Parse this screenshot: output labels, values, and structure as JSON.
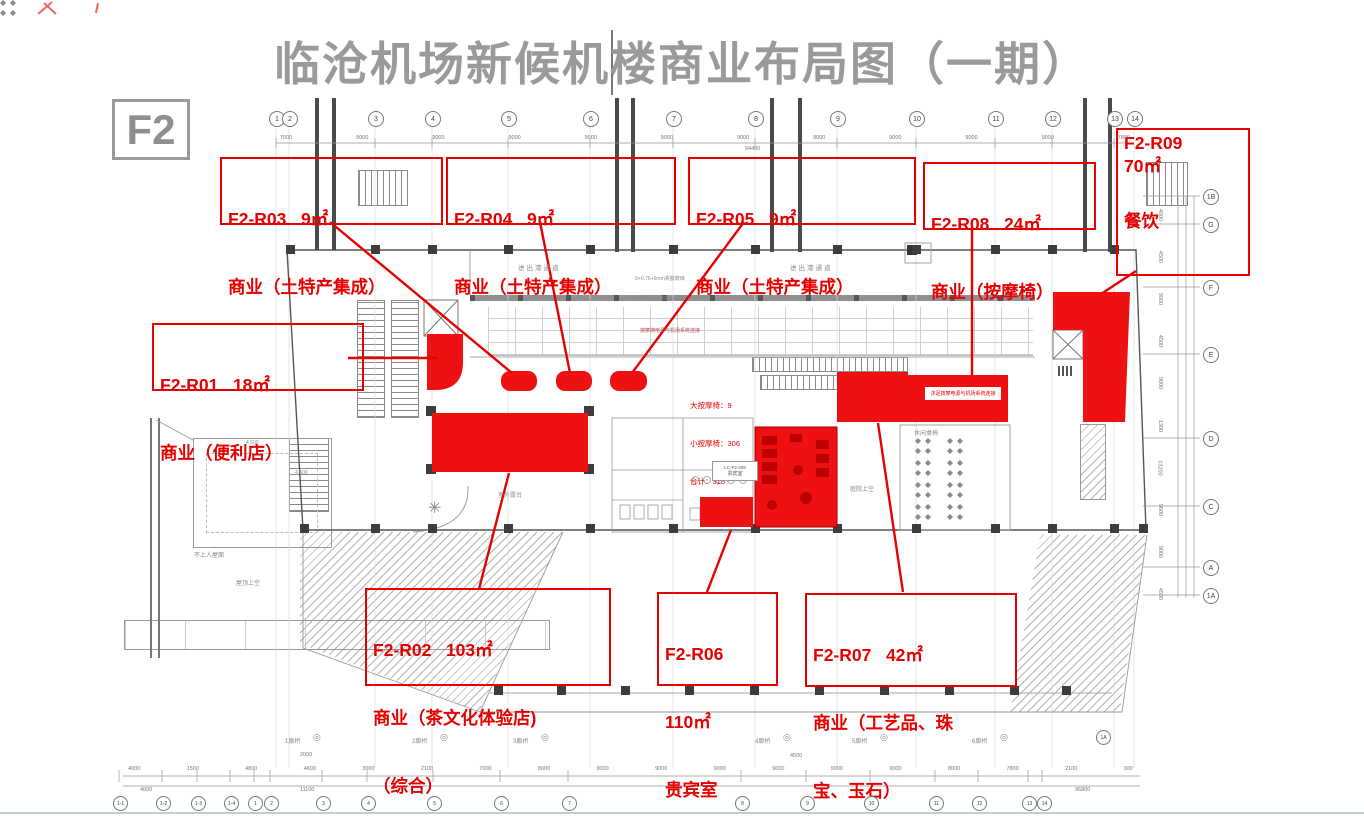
{
  "page": {
    "title": "临沧机场新候机楼商业布局图（一期）",
    "floor_label": "F2"
  },
  "colors": {
    "accent_red": "#e60000",
    "region_red": "#ee1111",
    "title_gray": "#9a9a9a",
    "line_gray": "#555555"
  },
  "labels": [
    {
      "id": "F2-R01",
      "line1": "F2-R01   18㎡",
      "line2": "商业（便利店）",
      "line3": ""
    },
    {
      "id": "F2-R02",
      "line1": "F2-R02   103㎡",
      "line2": "商业（茶文化体验店)",
      "line3": "（综合）"
    },
    {
      "id": "F2-R03",
      "line1": "F2-R03   9㎡",
      "line2": "商业（土特产集成）",
      "line3": ""
    },
    {
      "id": "F2-R04",
      "line1": "F2-R04   9㎡",
      "line2": "商业（土特产集成）",
      "line3": ""
    },
    {
      "id": "F2-R05",
      "line1": "F2-R05   9㎡",
      "line2": "商业（土特产集成）",
      "line3": ""
    },
    {
      "id": "F2-R06",
      "line1": "F2-R06",
      "line2": "110㎡",
      "line3": "贵宾室"
    },
    {
      "id": "F2-R07",
      "line1": "F2-R07   42㎡",
      "line2": "商业（工艺品、珠",
      "line3": "宝、玉石）"
    },
    {
      "id": "F2-R08",
      "line1": "F2-R08   24㎡",
      "line2": "商业（按摩椅）",
      "line3": ""
    },
    {
      "id": "F2-R09",
      "line1": "F2-R09",
      "line2": "70㎡",
      "line3": "餐饮"
    }
  ],
  "stats": {
    "line1": "大按摩椅：9",
    "line2": "小按摩椅：306",
    "line3": "合计：315"
  },
  "notes": {
    "passage_left": "进出港通道",
    "passage_right": "进出港通道",
    "glass_line1": "6+0.76+6mm夹胶玻璃",
    "glass_line2": "平钢化至3000mm高",
    "power_note": "按摩椅电源与机场系统连接",
    "foot_massage_note": "沐足按摩电源与机场系统连接",
    "leisure_seating": "休闲桌椅",
    "courtyard_void": "庭院上空",
    "roof_void": "屋顶上空",
    "no_access_roof": "不上人屋面",
    "outdoor_terrace": "室外露台",
    "vip_room_code": "LC-F2-409",
    "vip_room_name": "贵宾室",
    "level_mark_1": "4.500",
    "level_mark_2": "4.500",
    "bridge_dim_1": "2000",
    "bridge_dim_2": "4500"
  },
  "grid": {
    "top": [
      "1",
      "2",
      "3",
      "4",
      "5",
      "6",
      "7",
      "8",
      "9",
      "10",
      "11",
      "12",
      "13",
      "14"
    ],
    "bottom": [
      "1-1",
      "1-2",
      "1-3",
      "1-4",
      "1",
      "2",
      "3",
      "4",
      "5",
      "6",
      "7",
      "8",
      "9",
      "10",
      "11",
      "12",
      "13",
      "14"
    ],
    "right": [
      "1B",
      "G",
      "F",
      "E",
      "D",
      "C",
      "A",
      "1A"
    ],
    "corner": "1A"
  },
  "bridges": [
    "1廊桥",
    "2廊桥",
    "3廊桥",
    "4廊桥",
    "5廊桥",
    "6廊桥"
  ],
  "icons": {
    "double_circle": "◎",
    "plant": "✳"
  },
  "dimensions": {
    "top": [
      "7000",
      "8000",
      "9000",
      "9000",
      "9000",
      "9000",
      "9000",
      "9000",
      "9000",
      "9000",
      "9000",
      "7800"
    ],
    "top_total": "94400",
    "bottom": [
      "4000",
      "1500",
      "4800",
      "4800",
      "3000",
      "2100",
      "7000",
      "8000",
      "9000",
      "9000",
      "9000",
      "9000",
      "9000",
      "9000",
      "8000",
      "7800",
      "2100",
      "300"
    ],
    "bottom_total": "96800",
    "bottom_sub_left": "4000",
    "bottom_sub_mid": "11100",
    "right": [
      "4000",
      "4500",
      "9000",
      "4500",
      "9000",
      "1300",
      "13200",
      "9600",
      "9000",
      "4500"
    ]
  }
}
